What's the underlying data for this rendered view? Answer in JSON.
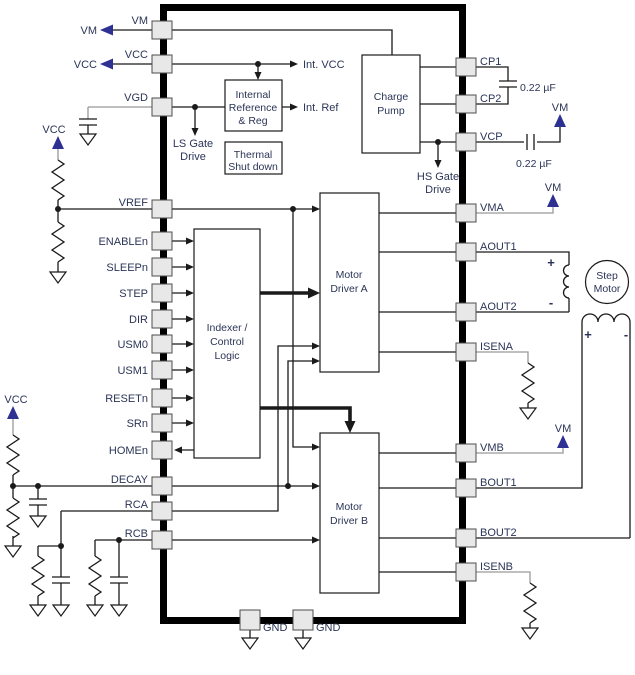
{
  "figure": {
    "kind": "stepper-motor-driver functional block diagram"
  },
  "pins": {
    "left": [
      "VM",
      "VCC",
      "VGD",
      "VREF",
      "ENABLEn",
      "SLEEPn",
      "STEP",
      "DIR",
      "USM0",
      "USM1",
      "RESETn",
      "SRn",
      "HOMEn",
      "DECAY",
      "RCA",
      "RCB"
    ],
    "right": [
      "CP1",
      "CP2",
      "VCP",
      "VMA",
      "AOUT1",
      "AOUT2",
      "ISENA",
      "VMB",
      "BOUT1",
      "BOUT2",
      "ISENB"
    ],
    "bottom": [
      "GND",
      "GND"
    ]
  },
  "blocks": {
    "charge_pump": {
      "l1": "Charge",
      "l2": "Pump"
    },
    "internal_ref": {
      "l1": "Internal",
      "l2": "Reference",
      "l3": "& Reg"
    },
    "thermal": {
      "l1": "Thermal",
      "l2": "Shut down"
    },
    "indexer": {
      "l1": "Indexer /",
      "l2": "Control",
      "l3": "Logic"
    },
    "motor_driver_a": {
      "l1": "Motor",
      "l2": "Driver A"
    },
    "motor_driver_b": {
      "l1": "Motor",
      "l2": "Driver B"
    },
    "step_motor": {
      "l1": "Step",
      "l2": "Motor"
    }
  },
  "labels": {
    "vm": "VM",
    "vcc": "VCC",
    "int_vcc": "Int. VCC",
    "int_ref": "Int. Ref",
    "ls_gate_1": "LS Gate",
    "ls_gate_2": "Drive",
    "hs_gate_1": "HS Gate",
    "hs_gate_2": "Drive",
    "cap_value": "0.22 µF",
    "plus": "+",
    "minus": "-"
  },
  "colors": {
    "wire": "#1a1a1a",
    "gray_wire": "#999999",
    "navy_accent": "#2e3192",
    "text": "#2b3557",
    "pin_fill": "#e8e8e8"
  }
}
